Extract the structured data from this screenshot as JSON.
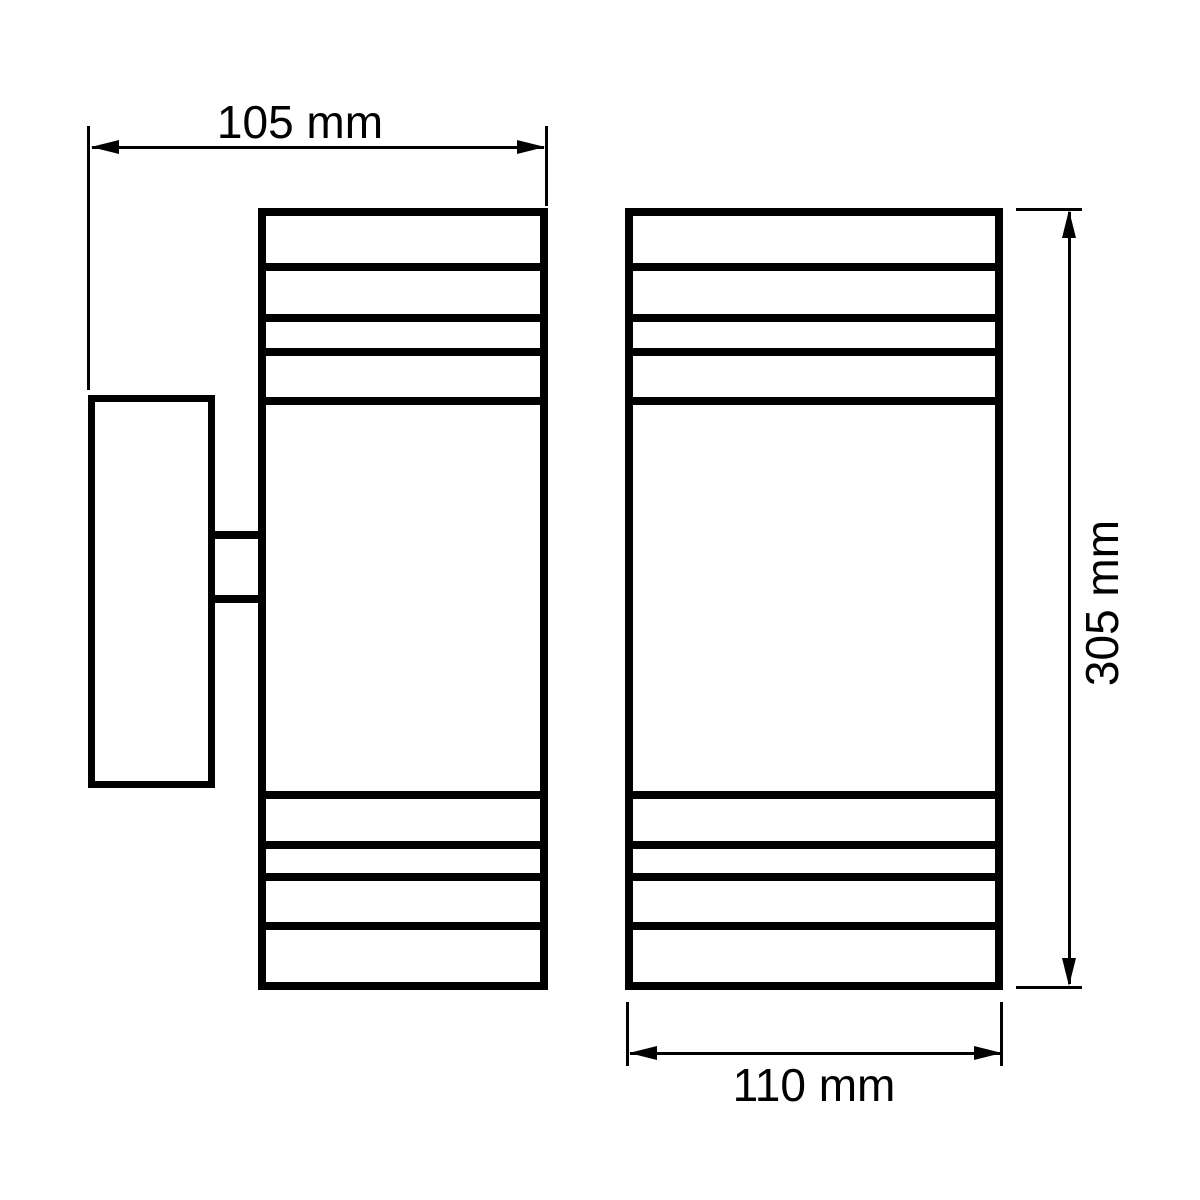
{
  "drawing": {
    "background_color": "#ffffff",
    "line_color": "#000000",
    "dimensions": {
      "depth_label": "105 mm",
      "height_label": "305 mm",
      "width_label": "110 mm"
    }
  }
}
